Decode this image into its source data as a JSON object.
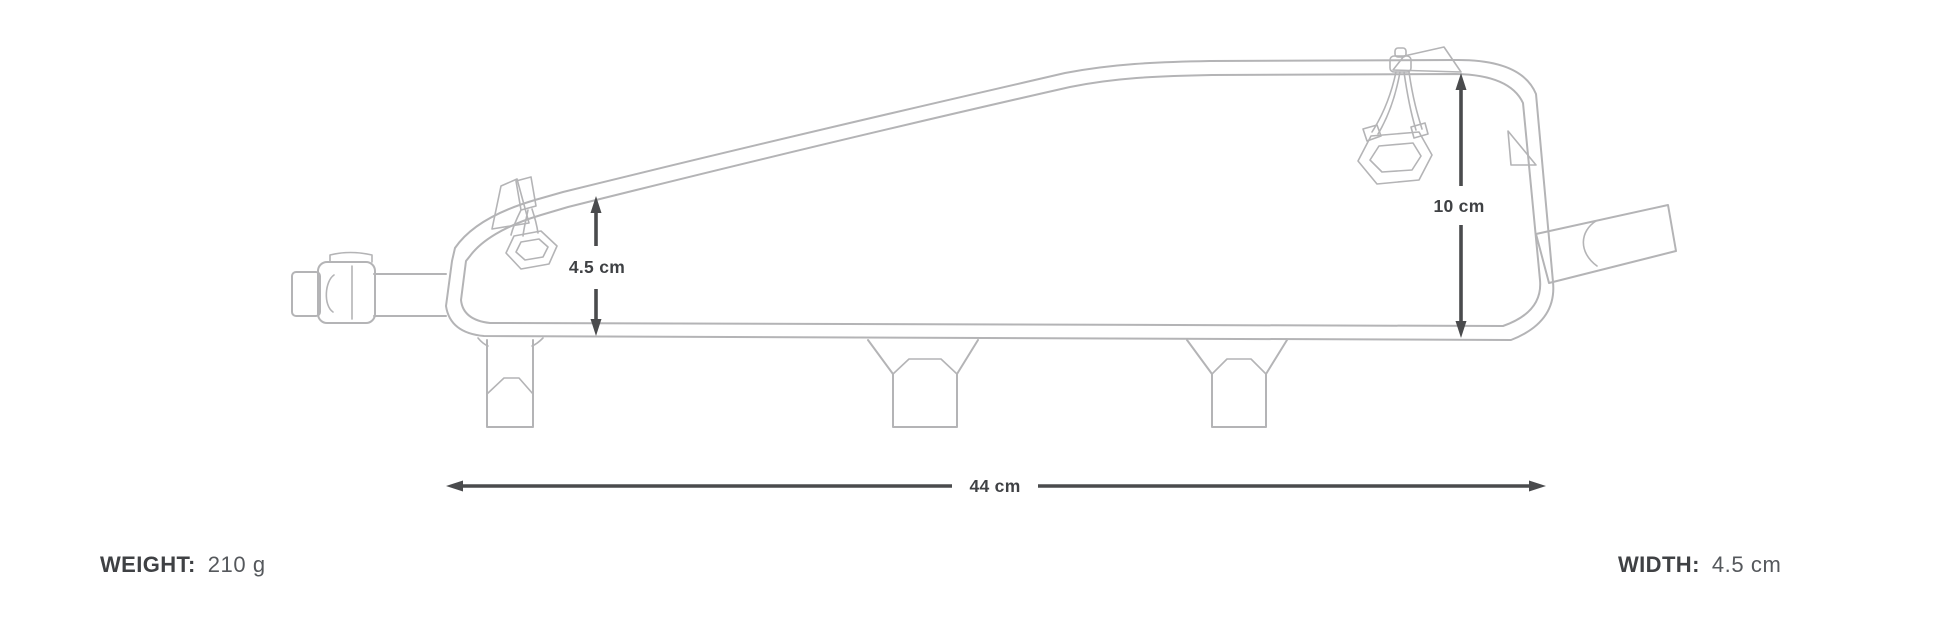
{
  "diagram": {
    "subject": "top-tube bike bag side-view line drawing with dimension arrows",
    "dimensions": {
      "height_small": "4.5 cm",
      "height_large": "10 cm",
      "length": "44 cm"
    }
  },
  "specs": {
    "weight_label": "WEIGHT:",
    "weight_value": "210 g",
    "width_label": "WIDTH:",
    "width_value": "4.5 cm"
  },
  "colors": {
    "line": "#b4b4b6",
    "dimension": "#4a4b4d",
    "text": "#3f4144"
  }
}
